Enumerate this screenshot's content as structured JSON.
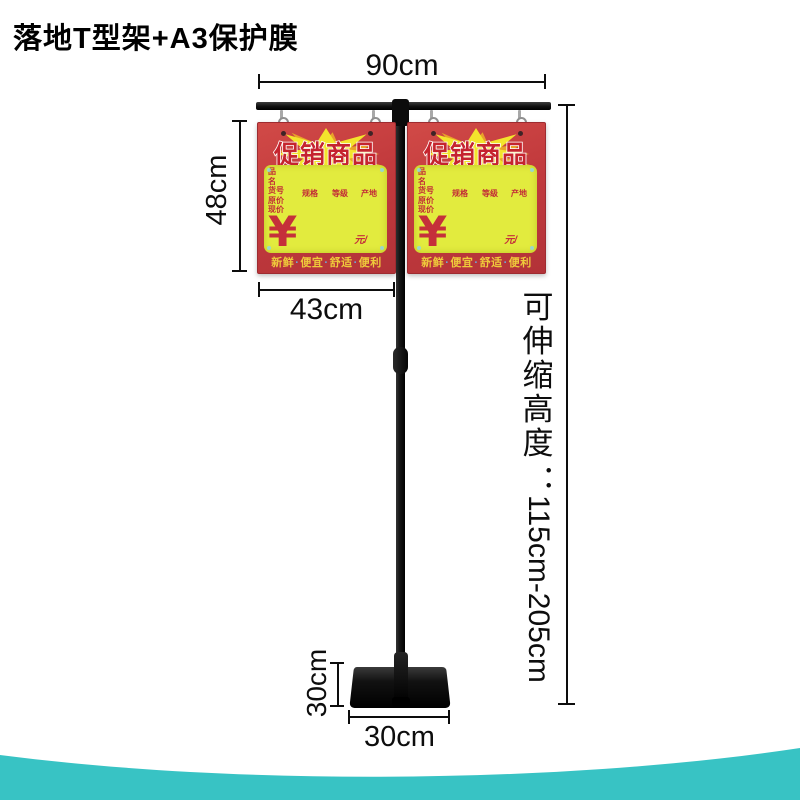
{
  "page": {
    "title": "落地T型架+A3保护膜"
  },
  "annotations": {
    "crossbar_width": "90cm",
    "sign_height": "48cm",
    "sign_width": "43cm",
    "adjustable_height_label": "可伸缩高度",
    "adjustable_height_range": "：115cm-205cm",
    "base_depth": "30cm",
    "base_width": "30cm"
  },
  "sign": {
    "title": "促销商品",
    "left_labels": [
      "品",
      "名",
      "货号",
      "原价",
      "现价"
    ],
    "spec_labels": [
      "规格",
      "等级",
      "产地"
    ],
    "currency_symbol": "¥",
    "unit_label": "元/",
    "slogan_words": [
      "新鲜",
      "便宜",
      "舒适",
      "便利"
    ],
    "slogan_separator": "·"
  },
  "colors": {
    "sign_red": "#c23a3d",
    "panel_yellow_green": "#e2eb3e",
    "burst_yellow": "#f3e42c",
    "burst_orange": "#e8a22a",
    "sign_title_red": "#c5242e",
    "slogan_gold": "#efcb3b",
    "stand_black": "#141414",
    "dimension_black": "#0d0d0d",
    "wave_teal": "#38c3c4"
  }
}
